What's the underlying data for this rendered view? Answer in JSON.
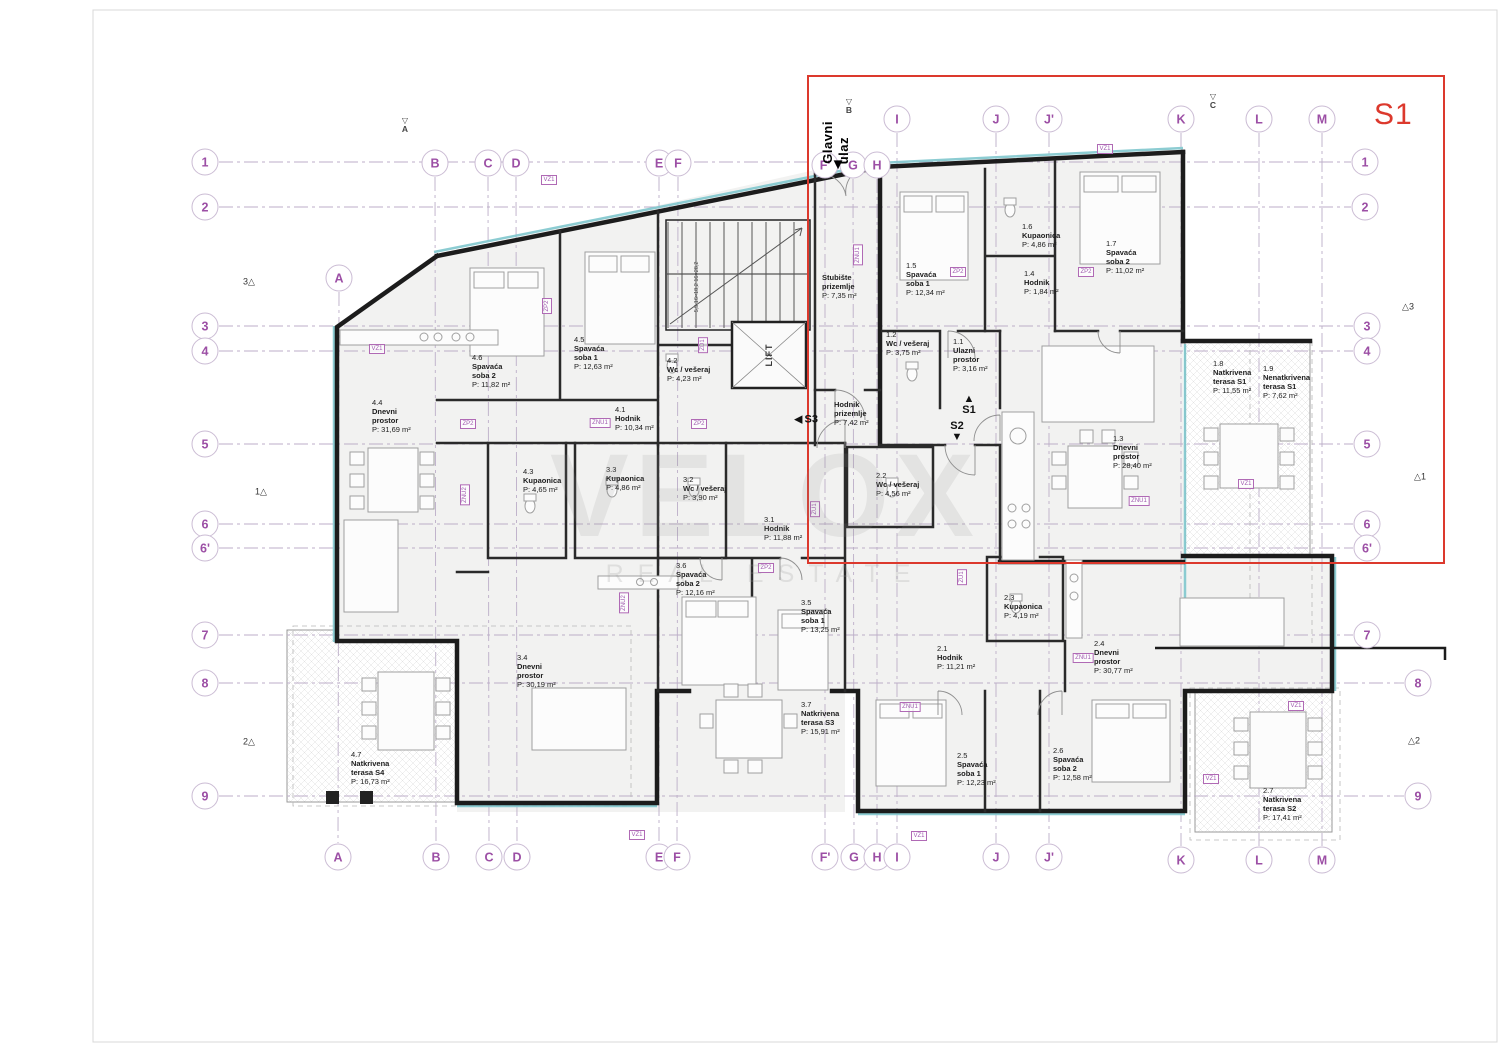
{
  "sheet": {
    "border_color": "#d8d8d8"
  },
  "watermark": {
    "title": "VELOX",
    "subtitle": "REAL ESTATE"
  },
  "highlight": {
    "label": "S1",
    "color": "#dc392d"
  },
  "entrance": {
    "line1": "Glavni",
    "line2": "ulaz"
  },
  "stair": {
    "lift_label": "LIFT",
    "flight_label": "5,5",
    "note1": "16×18,2",
    "note2": "16×28,2"
  },
  "unit_markers": [
    {
      "id": "S1",
      "dir": "up",
      "x": 969,
      "y": 405
    },
    {
      "id": "S2",
      "dir": "down",
      "x": 957,
      "y": 432
    },
    {
      "id": "S3",
      "dir": "left",
      "x": 806,
      "y": 420
    }
  ],
  "view_markers": [
    {
      "id": "A",
      "x": 405,
      "y": 125
    },
    {
      "id": "B",
      "x": 849,
      "y": 106
    },
    {
      "id": "C",
      "x": 1213,
      "y": 101
    }
  ],
  "grid": {
    "line_color": "#bcaec8",
    "bubble_text_color": "#9c4fa5",
    "columns": [
      {
        "label": "A",
        "xt": 339,
        "yt": 278,
        "xb": 338,
        "yb": 857
      },
      {
        "label": "B",
        "xt": 435,
        "yt": 163,
        "xb": 436,
        "yb": 857
      },
      {
        "label": "C",
        "xt": 488,
        "yt": 163,
        "xb": 489,
        "yb": 857
      },
      {
        "label": "D",
        "xt": 516,
        "yt": 163,
        "xb": 517,
        "yb": 857
      },
      {
        "label": "E",
        "xt": 659,
        "yt": 163,
        "xb": 659,
        "yb": 857
      },
      {
        "label": "F",
        "xt": 678,
        "yt": 163,
        "xb": 677,
        "yb": 857
      },
      {
        "label": "F'",
        "xt": 825,
        "yt": 165,
        "xb": 825,
        "yb": 857
      },
      {
        "label": "G",
        "xt": 853,
        "yt": 165,
        "xb": 854,
        "yb": 857
      },
      {
        "label": "H",
        "xt": 877,
        "yt": 165,
        "xb": 877,
        "yb": 857
      },
      {
        "label": "I",
        "xt": 897,
        "yt": 119,
        "xb": 897,
        "yb": 857
      },
      {
        "label": "J",
        "xt": 996,
        "yt": 119,
        "xb": 996,
        "yb": 857
      },
      {
        "label": "J'",
        "xt": 1049,
        "yt": 119,
        "xb": 1049,
        "yb": 857
      },
      {
        "label": "K",
        "xt": 1181,
        "yt": 119,
        "xb": 1181,
        "yb": 860
      },
      {
        "label": "L",
        "xt": 1259,
        "yt": 119,
        "xb": 1259,
        "yb": 860
      },
      {
        "label": "M",
        "xt": 1322,
        "yt": 119,
        "xb": 1322,
        "yb": 860
      }
    ],
    "rows": [
      {
        "label": "1",
        "y": 162,
        "xl": 205,
        "xr": 1365
      },
      {
        "label": "2",
        "y": 207,
        "xl": 205,
        "xr": 1365
      },
      {
        "label": "3",
        "y": 326,
        "xl": 205,
        "xr": 1367
      },
      {
        "label": "4",
        "y": 351,
        "xl": 205,
        "xr": 1367
      },
      {
        "label": "5",
        "y": 444,
        "xl": 205,
        "xr": 1367
      },
      {
        "label": "6",
        "y": 524,
        "xl": 205,
        "xr": 1367
      },
      {
        "label": "6'",
        "y": 548,
        "xl": 205,
        "xr": 1367
      },
      {
        "label": "7",
        "y": 635,
        "xl": 205,
        "xr": 1367
      },
      {
        "label": "8",
        "y": 683,
        "xl": 205,
        "xr": 1418
      },
      {
        "label": "9",
        "y": 796,
        "xl": 205,
        "xr": 1418
      }
    ],
    "deltas": [
      {
        "label": "3",
        "x": 249,
        "y": 282,
        "side": "left"
      },
      {
        "label": "1",
        "x": 261,
        "y": 492,
        "side": "left"
      },
      {
        "label": "2",
        "x": 249,
        "y": 742,
        "side": "left"
      },
      {
        "label": "3",
        "x": 1408,
        "y": 307,
        "side": "right"
      },
      {
        "label": "1",
        "x": 1420,
        "y": 477,
        "side": "right"
      },
      {
        "label": "2",
        "x": 1414,
        "y": 741,
        "side": "right"
      }
    ]
  },
  "rooms": [
    {
      "id": "1.1",
      "n1": "Ulazni",
      "n2": "prostor",
      "area": "P: 3,16 m²",
      "x": 953,
      "y": 337
    },
    {
      "id": "1.2",
      "n1": "Wc / vešeraj",
      "n2": "",
      "area": "P: 3,75 m²",
      "x": 886,
      "y": 330
    },
    {
      "id": "1.3",
      "n1": "Dnevni",
      "n2": "prostor",
      "area": "P: 28,40 m²",
      "x": 1113,
      "y": 434
    },
    {
      "id": "1.4",
      "n1": "Hodnik",
      "n2": "",
      "area": "P: 1,84 m²",
      "x": 1024,
      "y": 269
    },
    {
      "id": "1.5",
      "n1": "Spavaća",
      "n2": "soba 1",
      "area": "P: 12,34 m²",
      "x": 906,
      "y": 261
    },
    {
      "id": "1.6",
      "n1": "Kupaonica",
      "n2": "",
      "area": "P: 4,86 m²",
      "x": 1022,
      "y": 222
    },
    {
      "id": "1.7",
      "n1": "Spavaća",
      "n2": "soba 2",
      "area": "P: 11,02 m²",
      "x": 1106,
      "y": 239
    },
    {
      "id": "1.8",
      "n1": "Natkrivena",
      "n2": "terasa S1",
      "area": "P: 11,55 m²",
      "x": 1213,
      "y": 359
    },
    {
      "id": "1.9",
      "n1": "Nenatkrivena",
      "n2": "terasa S1",
      "area": "P: 7,62 m²",
      "x": 1263,
      "y": 364
    },
    {
      "id": "",
      "n1": "Stubište",
      "n2": "prizemlje",
      "area": "P: 7,35 m²",
      "x": 822,
      "y": 273
    },
    {
      "id": "",
      "n1": "Hodnik",
      "n2": "prizemlje",
      "area": "P: 7,42 m²",
      "x": 834,
      "y": 400
    },
    {
      "id": "2.1",
      "n1": "Hodnik",
      "n2": "",
      "area": "P: 11,21 m²",
      "x": 937,
      "y": 644
    },
    {
      "id": "2.2",
      "n1": "Wc / vešeraj",
      "n2": "",
      "area": "P: 4,56 m²",
      "x": 876,
      "y": 471
    },
    {
      "id": "2.3",
      "n1": "Kupaonica",
      "n2": "",
      "area": "P: 4,19 m²",
      "x": 1004,
      "y": 593
    },
    {
      "id": "2.4",
      "n1": "Dnevni",
      "n2": "prostor",
      "area": "P: 30,77 m²",
      "x": 1094,
      "y": 639
    },
    {
      "id": "2.5",
      "n1": "Spavaća",
      "n2": "soba 1",
      "area": "P: 12,23 m²",
      "x": 957,
      "y": 751
    },
    {
      "id": "2.6",
      "n1": "Spavaća",
      "n2": "soba 2",
      "area": "P: 12,58 m²",
      "x": 1053,
      "y": 746
    },
    {
      "id": "2.7",
      "n1": "Natkrivena",
      "n2": "terasa S2",
      "area": "P: 17,41 m²",
      "x": 1263,
      "y": 786
    },
    {
      "id": "3.1",
      "n1": "Hodnik",
      "n2": "",
      "area": "P: 11,88 m²",
      "x": 764,
      "y": 515
    },
    {
      "id": "3.2",
      "n1": "Wc / vešeraj",
      "n2": "",
      "area": "P: 3,90 m²",
      "x": 683,
      "y": 475
    },
    {
      "id": "3.3",
      "n1": "Kupaonica",
      "n2": "",
      "area": "P: 4,86 m²",
      "x": 606,
      "y": 465
    },
    {
      "id": "3.4",
      "n1": "Dnevni",
      "n2": "prostor",
      "area": "P: 30,19 m²",
      "x": 517,
      "y": 653
    },
    {
      "id": "3.5",
      "n1": "Spavaća",
      "n2": "soba 1",
      "area": "P: 13,25 m²",
      "x": 801,
      "y": 598
    },
    {
      "id": "3.6",
      "n1": "Spavaća",
      "n2": "soba 2",
      "area": "P: 12,16 m²",
      "x": 676,
      "y": 561
    },
    {
      "id": "3.7",
      "n1": "Natkrivena",
      "n2": "terasa S3",
      "area": "P: 15,91 m²",
      "x": 801,
      "y": 700
    },
    {
      "id": "4.1",
      "n1": "Hodnik",
      "n2": "",
      "area": "P: 10,34 m²",
      "x": 615,
      "y": 405
    },
    {
      "id": "4.2",
      "n1": "Wc / vešeraj",
      "n2": "",
      "area": "P: 4,23 m²",
      "x": 667,
      "y": 356
    },
    {
      "id": "4.3",
      "n1": "Kupaonica",
      "n2": "",
      "area": "P: 4,65 m²",
      "x": 523,
      "y": 467
    },
    {
      "id": "4.4",
      "n1": "Dnevni",
      "n2": "prostor",
      "area": "P: 31,69 m²",
      "x": 372,
      "y": 398
    },
    {
      "id": "4.5",
      "n1": "Spavaća",
      "n2": "soba 1",
      "area": "P: 12,63 m²",
      "x": 574,
      "y": 335
    },
    {
      "id": "4.6",
      "n1": "Spavaća",
      "n2": "soba 2",
      "area": "P: 11,82 m²",
      "x": 472,
      "y": 353
    },
    {
      "id": "4.7",
      "n1": "Natkrivena",
      "n2": "terasa S4",
      "area": "P: 16,73 m²",
      "x": 351,
      "y": 750
    }
  ],
  "ref_tags": [
    {
      "label": "VZ1",
      "x": 377,
      "y": 349,
      "r": 0
    },
    {
      "label": "VZ1",
      "x": 549,
      "y": 180,
      "r": 0
    },
    {
      "label": "VZ1",
      "x": 1105,
      "y": 149,
      "r": 0
    },
    {
      "label": "VZ1",
      "x": 1246,
      "y": 484,
      "r": 0
    },
    {
      "label": "VZ1",
      "x": 637,
      "y": 835,
      "r": 0
    },
    {
      "label": "VZ1",
      "x": 919,
      "y": 836,
      "r": 0
    },
    {
      "label": "VZ1",
      "x": 1296,
      "y": 706,
      "r": 0
    },
    {
      "label": "VZ1",
      "x": 1211,
      "y": 779,
      "r": 0
    },
    {
      "label": "ZP2",
      "x": 468,
      "y": 424,
      "r": 0
    },
    {
      "label": "ZP2",
      "x": 699,
      "y": 424,
      "r": 0
    },
    {
      "label": "ZP2",
      "x": 958,
      "y": 272,
      "r": 0
    },
    {
      "label": "ZP2",
      "x": 1086,
      "y": 272,
      "r": 0
    },
    {
      "label": "ZP2",
      "x": 766,
      "y": 568,
      "r": 0
    },
    {
      "label": "ZP2",
      "x": 547,
      "y": 306,
      "r": 90
    },
    {
      "label": "ZNU1",
      "x": 600,
      "y": 423,
      "r": 0
    },
    {
      "label": "ZNU1",
      "x": 1139,
      "y": 501,
      "r": 0
    },
    {
      "label": "ZNU1",
      "x": 1083,
      "y": 658,
      "r": 0
    },
    {
      "label": "ZNU1",
      "x": 910,
      "y": 707,
      "r": 0
    },
    {
      "label": "ZNU1",
      "x": 858,
      "y": 255,
      "r": 90
    },
    {
      "label": "ZNU2",
      "x": 465,
      "y": 495,
      "r": 90
    },
    {
      "label": "ZNU2",
      "x": 624,
      "y": 603,
      "r": 90
    },
    {
      "label": "ZD1",
      "x": 703,
      "y": 345,
      "r": 90
    },
    {
      "label": "ZU1",
      "x": 815,
      "y": 509,
      "r": 90
    },
    {
      "label": "ZU1",
      "x": 962,
      "y": 577,
      "r": 90
    }
  ]
}
